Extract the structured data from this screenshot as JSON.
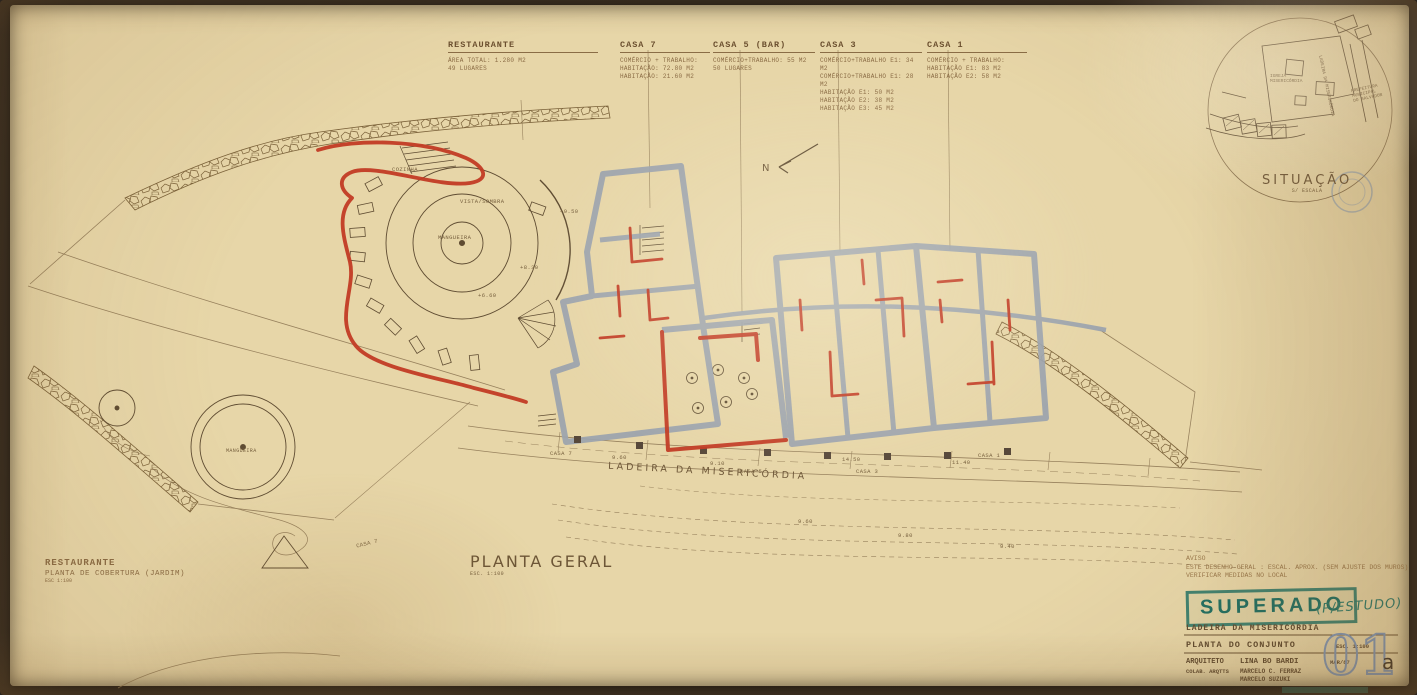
{
  "annotations": {
    "restaurante": {
      "title": "RESTAURANTE",
      "lines": [
        "ÁREA TOTAL: 1.280 M2",
        "49 LUGARES"
      ]
    },
    "casa7": {
      "title": "CASA 7",
      "lines": [
        "COMÉRCIO + TRABALHO:",
        "HABITAÇÃO: 72.80 M2",
        "HABITAÇÃO: 21.60 M2"
      ]
    },
    "casa5": {
      "title": "CASA 5 (BAR)",
      "lines": [
        "COMÉRCIO+TRABALHO: 55 M2",
        "50 LUGARES"
      ]
    },
    "casa3": {
      "title": "CASA 3",
      "lines": [
        "COMÉRCIO+TRABALHO E1: 34 M2",
        "COMÉRCIO+TRABALHO E1: 28 M2",
        "HABITAÇÃO E1: 50 M2",
        "HABITAÇÃO E2: 38 M2",
        "HABITAÇÃO E3: 45 M2"
      ]
    },
    "casa1": {
      "title": "CASA 1",
      "lines": [
        "COMÉRCIO + TRABALHO:",
        "HABITAÇÃO E1: 83 M2",
        "HABITAÇÃO E2: 58 M2"
      ]
    }
  },
  "plan": {
    "north": "N",
    "cozinha": "COZINHA",
    "vista_sombra": "VISTA/SOMBRA",
    "mangueira": "MANGUEIRA",
    "elev1": "+9.50",
    "elev2": "+8.30",
    "elev3": "+6.60",
    "street": "LADEIRA  DA  MISERICÓRDIA",
    "casa7_street": "CASA 7",
    "casa5_street": "CASA 5",
    "casa3_street": "CASA 3",
    "casa1_street": "CASA 1",
    "dim1": "14.50",
    "dim2": "9.10",
    "dim3": "11.40",
    "dim4": "9.60",
    "contour1": "9.60",
    "contour2": "9.80",
    "contour3": "9.40"
  },
  "planta_geral": {
    "title": "PLANTA GERAL",
    "scale": "ESC. 1:100"
  },
  "cobertura": {
    "title": "RESTAURANTE",
    "subtitle": "PLANTA DE COBERTURA (JARDIM)",
    "scale": "ESC 1:100",
    "mangueira": "MANGUEIRA",
    "casa_label": "CASA 7"
  },
  "situacao": {
    "title": "SITUAÇÃO",
    "scale": "S/ ESCALA",
    "igreja_1": "IGREJA",
    "igreja_2": "MISERICÓRDIA",
    "prefeitura_1": "PREFEITURA",
    "prefeitura_2": "MUNICIPAL",
    "prefeitura_3": "DO SALVADOR",
    "street": "LADEIRA DA MISERICÓRDIA"
  },
  "notes": {
    "line1": "AVISO",
    "line2": "ESTE DESENHO-GERAL : ESCAL. APROX. (SEM AJUSTE DOS MUROS)",
    "line3": "VERIFICAR MEDIDAS NO LOCAL"
  },
  "stamp": {
    "text": "SUPERADO",
    "note": "(P/ESTUDO)"
  },
  "titleblock": {
    "project": "LADEIRA  DA  MISERICÓRDIA",
    "sheet_title": "PLANTA  DO  CONJUNTO",
    "scale": "ESC. 1:100",
    "architect_label": "ARQUITETO",
    "architect": "LINA  BO  BARDI",
    "date": "MAR/87",
    "collab_label": "COLAB. ARQTTS",
    "collab1": "MARCELO C. FERRAZ",
    "collab2": "MARCELO SUZUKI",
    "sheet_number": "01",
    "sheet_suffix": "a"
  },
  "colors": {
    "red_marker": "#c23b24",
    "wall_gray": "#9ba3ae",
    "stamp_teal": "#2e7d6e",
    "numeral_blue": "#8097b6",
    "paper": "#e7d6a8"
  }
}
